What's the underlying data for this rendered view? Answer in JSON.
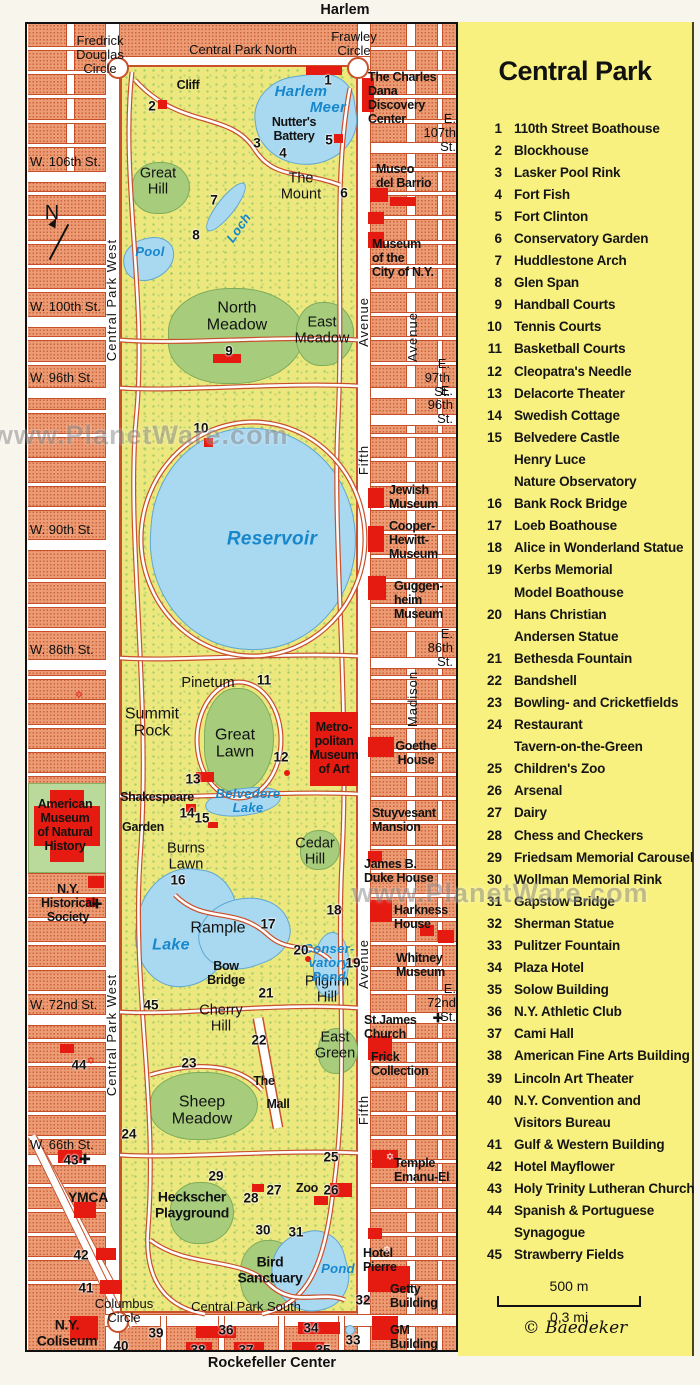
{
  "colors": {
    "block": "#EC9B74",
    "park": "#EDE87E",
    "lawn": "#A6CC7C",
    "water": "#A9D8F1",
    "red": "#E51A10",
    "legend_bg": "#F8F180",
    "water_text": "#1787CC",
    "street": "#FFFFFF"
  },
  "top_label": "Harlem",
  "bottom_label": "Rockefeller Center",
  "watermark": "www.PlanetWare.com",
  "legend": {
    "title": "Central Park",
    "scale_metric": "500 m",
    "scale_imperial": "0,3 mi",
    "credit": "© Baedeker",
    "items": [
      {
        "num": "1",
        "lines": [
          "110th Street Boathouse"
        ]
      },
      {
        "num": "2",
        "lines": [
          "Blockhouse"
        ]
      },
      {
        "num": "3",
        "lines": [
          "Lasker Pool Rink"
        ]
      },
      {
        "num": "4",
        "lines": [
          "Fort Fish"
        ]
      },
      {
        "num": "5",
        "lines": [
          "Fort Clinton"
        ]
      },
      {
        "num": "6",
        "lines": [
          "Conservatory Garden"
        ]
      },
      {
        "num": "7",
        "lines": [
          "Huddlestone Arch"
        ]
      },
      {
        "num": "8",
        "lines": [
          "Glen Span"
        ]
      },
      {
        "num": "9",
        "lines": [
          "Handball Courts"
        ]
      },
      {
        "num": "10",
        "lines": [
          "Tennis Courts"
        ]
      },
      {
        "num": "11",
        "lines": [
          "Basketball Courts"
        ]
      },
      {
        "num": "12",
        "lines": [
          "Cleopatra's Needle"
        ]
      },
      {
        "num": "13",
        "lines": [
          "Delacorte Theater"
        ]
      },
      {
        "num": "14",
        "lines": [
          "Swedish Cottage"
        ]
      },
      {
        "num": "15",
        "lines": [
          "Belvedere Castle",
          "Henry Luce",
          "Nature Observatory"
        ]
      },
      {
        "num": "16",
        "lines": [
          "Bank Rock Bridge"
        ]
      },
      {
        "num": "17",
        "lines": [
          "Loeb Boathouse"
        ]
      },
      {
        "num": "18",
        "lines": [
          "Alice in Wonderland Statue"
        ]
      },
      {
        "num": "19",
        "lines": [
          "Kerbs Memorial",
          "Model Boathouse"
        ]
      },
      {
        "num": "20",
        "lines": [
          "Hans Christian",
          "Andersen Statue"
        ]
      },
      {
        "num": "21",
        "lines": [
          "Bethesda Fountain"
        ]
      },
      {
        "num": "22",
        "lines": [
          "Bandshell"
        ]
      },
      {
        "num": "23",
        "lines": [
          "Bowling- and Cricketfields"
        ]
      },
      {
        "num": "24",
        "lines": [
          "Restaurant",
          "Tavern-on-the-Green"
        ]
      },
      {
        "num": "25",
        "lines": [
          "Children's Zoo"
        ]
      },
      {
        "num": "26",
        "lines": [
          "Arsenal"
        ]
      },
      {
        "num": "27",
        "lines": [
          "Dairy"
        ]
      },
      {
        "num": "28",
        "lines": [
          "Chess and Checkers"
        ]
      },
      {
        "num": "29",
        "lines": [
          "Friedsam Memorial Carousel"
        ]
      },
      {
        "num": "30",
        "lines": [
          "Wollman Memorial Rink"
        ]
      },
      {
        "num": "31",
        "lines": [
          "Gapstow Bridge"
        ]
      },
      {
        "num": "32",
        "lines": [
          "Sherman Statue"
        ]
      },
      {
        "num": "33",
        "lines": [
          "Pulitzer Fountain"
        ]
      },
      {
        "num": "34",
        "lines": [
          "Plaza Hotel"
        ]
      },
      {
        "num": "35",
        "lines": [
          "Solow Building"
        ]
      },
      {
        "num": "36",
        "lines": [
          "N.Y. Athletic Club"
        ]
      },
      {
        "num": "37",
        "lines": [
          "Cami Hall"
        ]
      },
      {
        "num": "38",
        "lines": [
          "American Fine Arts Building"
        ]
      },
      {
        "num": "39",
        "lines": [
          "Lincoln Art Theater"
        ]
      },
      {
        "num": "40",
        "lines": [
          "N.Y. Convention and",
          "Visitors Bureau"
        ]
      },
      {
        "num": "41",
        "lines": [
          "Gulf & Western Building"
        ]
      },
      {
        "num": "42",
        "lines": [
          "Hotel Mayflower"
        ]
      },
      {
        "num": "43",
        "lines": [
          "Holy Trinity Lutheran Church"
        ]
      },
      {
        "num": "44",
        "lines": [
          "Spanish & Portuguese",
          "Synagogue"
        ]
      },
      {
        "num": "45",
        "lines": [
          "Strawberry Fields"
        ]
      }
    ]
  },
  "map": {
    "compass": "N",
    "street_labels": [
      {
        "t": "W. 106th St.",
        "x": 30,
        "y": 162,
        "a": "l"
      },
      {
        "t": "W. 100th St.",
        "x": 30,
        "y": 307,
        "a": "l"
      },
      {
        "t": "W. 96th St.",
        "x": 30,
        "y": 378,
        "a": "l"
      },
      {
        "t": "W. 90th St.",
        "x": 30,
        "y": 530,
        "a": "l"
      },
      {
        "t": "W. 86th St.",
        "x": 30,
        "y": 650,
        "a": "l"
      },
      {
        "t": "W. 72nd St.",
        "x": 30,
        "y": 1005,
        "a": "l"
      },
      {
        "t": "W. 66th St.",
        "x": 30,
        "y": 1145,
        "a": "l"
      },
      {
        "t": "E. 107th St.",
        "x": 456,
        "y": 133,
        "a": "r"
      },
      {
        "t": "E. 97th St.",
        "x": 450,
        "y": 378,
        "a": "r"
      },
      {
        "t": "E. 96th St.",
        "x": 453,
        "y": 405,
        "a": "r"
      },
      {
        "t": "E. 86th St.",
        "x": 453,
        "y": 648,
        "a": "r"
      },
      {
        "t": "E. 72nd St.",
        "x": 456,
        "y": 1003,
        "a": "r"
      },
      {
        "t": "Central Park North",
        "x": 243,
        "y": 50
      },
      {
        "t": "Central Park South",
        "x": 246,
        "y": 1307
      },
      {
        "t": "Fredrick\nDouglas\nCircle",
        "x": 100,
        "y": 55
      },
      {
        "t": "Frawley\nCircle",
        "x": 354,
        "y": 44
      },
      {
        "t": "Columbus\nCircle",
        "x": 124,
        "y": 1311
      }
    ],
    "area_labels": [
      {
        "t": "Great\nHill",
        "x": 158,
        "y": 182
      },
      {
        "t": "The\nMount",
        "x": 301,
        "y": 187
      },
      {
        "t": "North\nMeadow",
        "x": 237,
        "y": 317,
        "s": 16
      },
      {
        "t": "East\nMeadow",
        "x": 322,
        "y": 331
      },
      {
        "t": "Pinetum",
        "x": 208,
        "y": 684
      },
      {
        "t": "Summit\nRock",
        "x": 152,
        "y": 723,
        "s": 16
      },
      {
        "t": "Great\nLawn",
        "x": 235,
        "y": 744,
        "s": 16
      },
      {
        "t": "Burns\nLawn",
        "x": 186,
        "y": 857
      },
      {
        "t": "Cedar\nHill",
        "x": 315,
        "y": 852
      },
      {
        "t": "Rample",
        "x": 218,
        "y": 928,
        "s": 16
      },
      {
        "t": "Pilgrim\nHill",
        "x": 327,
        "y": 990
      },
      {
        "t": "Cherry\nHill",
        "x": 221,
        "y": 1019
      },
      {
        "t": "East\nGreen",
        "x": 335,
        "y": 1046
      },
      {
        "t": "Sheep\nMeadow",
        "x": 202,
        "y": 1111,
        "s": 16
      }
    ],
    "landmark_labels": [
      {
        "t": "Cliff",
        "x": 188,
        "y": 85
      },
      {
        "t": "Nutter's\nBattery",
        "x": 294,
        "y": 129
      },
      {
        "t": "The Charles\nDana Discovery\nCenter",
        "x": 368,
        "y": 98,
        "a": "l"
      },
      {
        "t": "Museo\ndel Barrio",
        "x": 376,
        "y": 176,
        "a": "l"
      },
      {
        "t": "Museum\nof the\nCity of N.Y.",
        "x": 372,
        "y": 258,
        "a": "l"
      },
      {
        "t": "Jewish\nMuseum",
        "x": 389,
        "y": 497,
        "a": "l"
      },
      {
        "t": "Cooper-\nHewitt-\nMuseum",
        "x": 389,
        "y": 540,
        "a": "l"
      },
      {
        "t": "Guggen-\nheim\nMuseum",
        "x": 394,
        "y": 600,
        "a": "l"
      },
      {
        "t": "Metro-\npolitan\nMuseum\nof Art",
        "x": 334,
        "y": 748
      },
      {
        "t": "Goethe\nHouse",
        "x": 416,
        "y": 753
      },
      {
        "t": "Shakespeare",
        "x": 157,
        "y": 797
      },
      {
        "t": "Garden",
        "x": 143,
        "y": 827
      },
      {
        "t": "Stuyvesant\nMansion",
        "x": 372,
        "y": 820,
        "a": "l"
      },
      {
        "t": "James B.\nDuke House",
        "x": 364,
        "y": 871,
        "a": "l"
      },
      {
        "t": "Harkness\nHouse",
        "x": 394,
        "y": 917,
        "a": "l"
      },
      {
        "t": "Whitney\nMuseum",
        "x": 396,
        "y": 965,
        "a": "l"
      },
      {
        "t": "St.James\nChurch",
        "x": 364,
        "y": 1027,
        "a": "l"
      },
      {
        "t": "Frick\nCollection",
        "x": 371,
        "y": 1064,
        "a": "l"
      },
      {
        "t": "American\nMuseum\nof Natural\nHistory",
        "x": 65,
        "y": 825
      },
      {
        "t": "N.Y.\nHistorical\nSociety",
        "x": 68,
        "y": 903
      },
      {
        "t": "YMCA",
        "x": 88,
        "y": 1198,
        "s": 14
      },
      {
        "t": "Temple\nEmanu-El",
        "x": 394,
        "y": 1170,
        "a": "l"
      },
      {
        "t": "Hotel\nPierre",
        "x": 363,
        "y": 1260,
        "a": "l"
      },
      {
        "t": "Getty\nBuilding",
        "x": 390,
        "y": 1296,
        "a": "l"
      },
      {
        "t": "GM\nBuilding",
        "x": 390,
        "y": 1337,
        "a": "l"
      },
      {
        "t": "N.Y.\nColiseum",
        "x": 67,
        "y": 1333,
        "s": 14
      },
      {
        "t": "Bow\nBridge",
        "x": 226,
        "y": 973
      },
      {
        "t": "The",
        "x": 264,
        "y": 1081
      },
      {
        "t": "Mall",
        "x": 278,
        "y": 1104
      },
      {
        "t": "Zoo",
        "x": 307,
        "y": 1188
      },
      {
        "t": "Heckscher\nPlayground",
        "x": 192,
        "y": 1205,
        "s": 14
      },
      {
        "t": "Bird\nSanctuary",
        "x": 270,
        "y": 1270,
        "s": 14
      }
    ],
    "water_labels": [
      {
        "t": "Harlem",
        "x": 301,
        "y": 92,
        "s": 15
      },
      {
        "t": "Meer",
        "x": 328,
        "y": 108,
        "s": 15
      },
      {
        "t": "Pool",
        "x": 150,
        "y": 252
      },
      {
        "t": "Loch",
        "x": 239,
        "y": 228,
        "r": -55
      },
      {
        "t": "Reservoir",
        "x": 272,
        "y": 540,
        "s": 19
      },
      {
        "t": "Belvedere\nLake",
        "x": 248,
        "y": 801
      },
      {
        "t": "Lake",
        "x": 171,
        "y": 945,
        "s": 16
      },
      {
        "t": "Conser-\nvatory\nPond",
        "x": 329,
        "y": 963
      },
      {
        "t": "Pond",
        "x": 338,
        "y": 1269
      }
    ],
    "vertical_labels": [
      {
        "t": "Central Park West",
        "x": 112,
        "y": 300
      },
      {
        "t": "Central Park West",
        "x": 112,
        "y": 1035
      },
      {
        "t": "West Side",
        "x": 13,
        "y": 640,
        "s": 12
      },
      {
        "t": "Avenue",
        "x": 364,
        "y": 322
      },
      {
        "t": "Fifth",
        "x": 364,
        "y": 460
      },
      {
        "t": "Avenue",
        "x": 364,
        "y": 964
      },
      {
        "t": "Fifth",
        "x": 364,
        "y": 1110
      },
      {
        "t": "Avenue",
        "x": 413,
        "y": 337
      },
      {
        "t": "Madison",
        "x": 413,
        "y": 699
      },
      {
        "t": "Yorkville",
        "x": 464,
        "y": 566,
        "r": 90,
        "s": 11
      }
    ],
    "markers": [
      {
        "n": "1",
        "x": 328,
        "y": 80
      },
      {
        "n": "2",
        "x": 152,
        "y": 106
      },
      {
        "n": "3",
        "x": 257,
        "y": 143
      },
      {
        "n": "4",
        "x": 283,
        "y": 153
      },
      {
        "n": "5",
        "x": 329,
        "y": 140
      },
      {
        "n": "6",
        "x": 344,
        "y": 193
      },
      {
        "n": "7",
        "x": 214,
        "y": 200
      },
      {
        "n": "8",
        "x": 196,
        "y": 235
      },
      {
        "n": "9",
        "x": 229,
        "y": 351
      },
      {
        "n": "10",
        "x": 201,
        "y": 428
      },
      {
        "n": "11",
        "x": 264,
        "y": 680
      },
      {
        "n": "12",
        "x": 281,
        "y": 757
      },
      {
        "n": "13",
        "x": 193,
        "y": 779
      },
      {
        "n": "14",
        "x": 187,
        "y": 813
      },
      {
        "n": "15",
        "x": 202,
        "y": 818
      },
      {
        "n": "16",
        "x": 178,
        "y": 880
      },
      {
        "n": "17",
        "x": 268,
        "y": 924
      },
      {
        "n": "18",
        "x": 334,
        "y": 910
      },
      {
        "n": "19",
        "x": 353,
        "y": 963
      },
      {
        "n": "20",
        "x": 301,
        "y": 950
      },
      {
        "n": "21",
        "x": 266,
        "y": 993
      },
      {
        "n": "22",
        "x": 259,
        "y": 1040
      },
      {
        "n": "23",
        "x": 189,
        "y": 1063
      },
      {
        "n": "24",
        "x": 129,
        "y": 1134
      },
      {
        "n": "25",
        "x": 331,
        "y": 1157
      },
      {
        "n": "26",
        "x": 331,
        "y": 1190
      },
      {
        "n": "27",
        "x": 274,
        "y": 1190
      },
      {
        "n": "28",
        "x": 251,
        "y": 1198
      },
      {
        "n": "29",
        "x": 216,
        "y": 1176
      },
      {
        "n": "30",
        "x": 263,
        "y": 1230
      },
      {
        "n": "31",
        "x": 296,
        "y": 1232
      },
      {
        "n": "32",
        "x": 363,
        "y": 1300
      },
      {
        "n": "33",
        "x": 353,
        "y": 1340
      },
      {
        "n": "34",
        "x": 311,
        "y": 1328
      },
      {
        "n": "35",
        "x": 323,
        "y": 1350
      },
      {
        "n": "36",
        "x": 226,
        "y": 1330
      },
      {
        "n": "37",
        "x": 246,
        "y": 1350
      },
      {
        "n": "38",
        "x": 198,
        "y": 1350
      },
      {
        "n": "39",
        "x": 156,
        "y": 1333
      },
      {
        "n": "40",
        "x": 121,
        "y": 1346
      },
      {
        "n": "41",
        "x": 86,
        "y": 1288
      },
      {
        "n": "42",
        "x": 81,
        "y": 1255
      },
      {
        "n": "43",
        "x": 71,
        "y": 1160
      },
      {
        "n": "44",
        "x": 79,
        "y": 1065
      },
      {
        "n": "45",
        "x": 151,
        "y": 1005
      }
    ],
    "icons": [
      {
        "g": "✡",
        "x": 79,
        "y": 696,
        "c": "#E51A10"
      },
      {
        "g": "✡",
        "x": 91,
        "y": 1062,
        "c": "#E51A10"
      },
      {
        "g": "✡",
        "x": 390,
        "y": 1158,
        "c": "#E51A10",
        "inv": 1
      },
      {
        "g": "✡",
        "x": 387,
        "y": 1251,
        "c": "#E51A10",
        "inv": 1
      },
      {
        "g": "✚",
        "x": 97,
        "y": 904,
        "c": "#111",
        "s": 13
      },
      {
        "g": "✚",
        "x": 85,
        "y": 1159,
        "c": "#111",
        "s": 14
      },
      {
        "g": "✚",
        "x": 438,
        "y": 1018,
        "c": "#111",
        "s": 13
      }
    ]
  }
}
